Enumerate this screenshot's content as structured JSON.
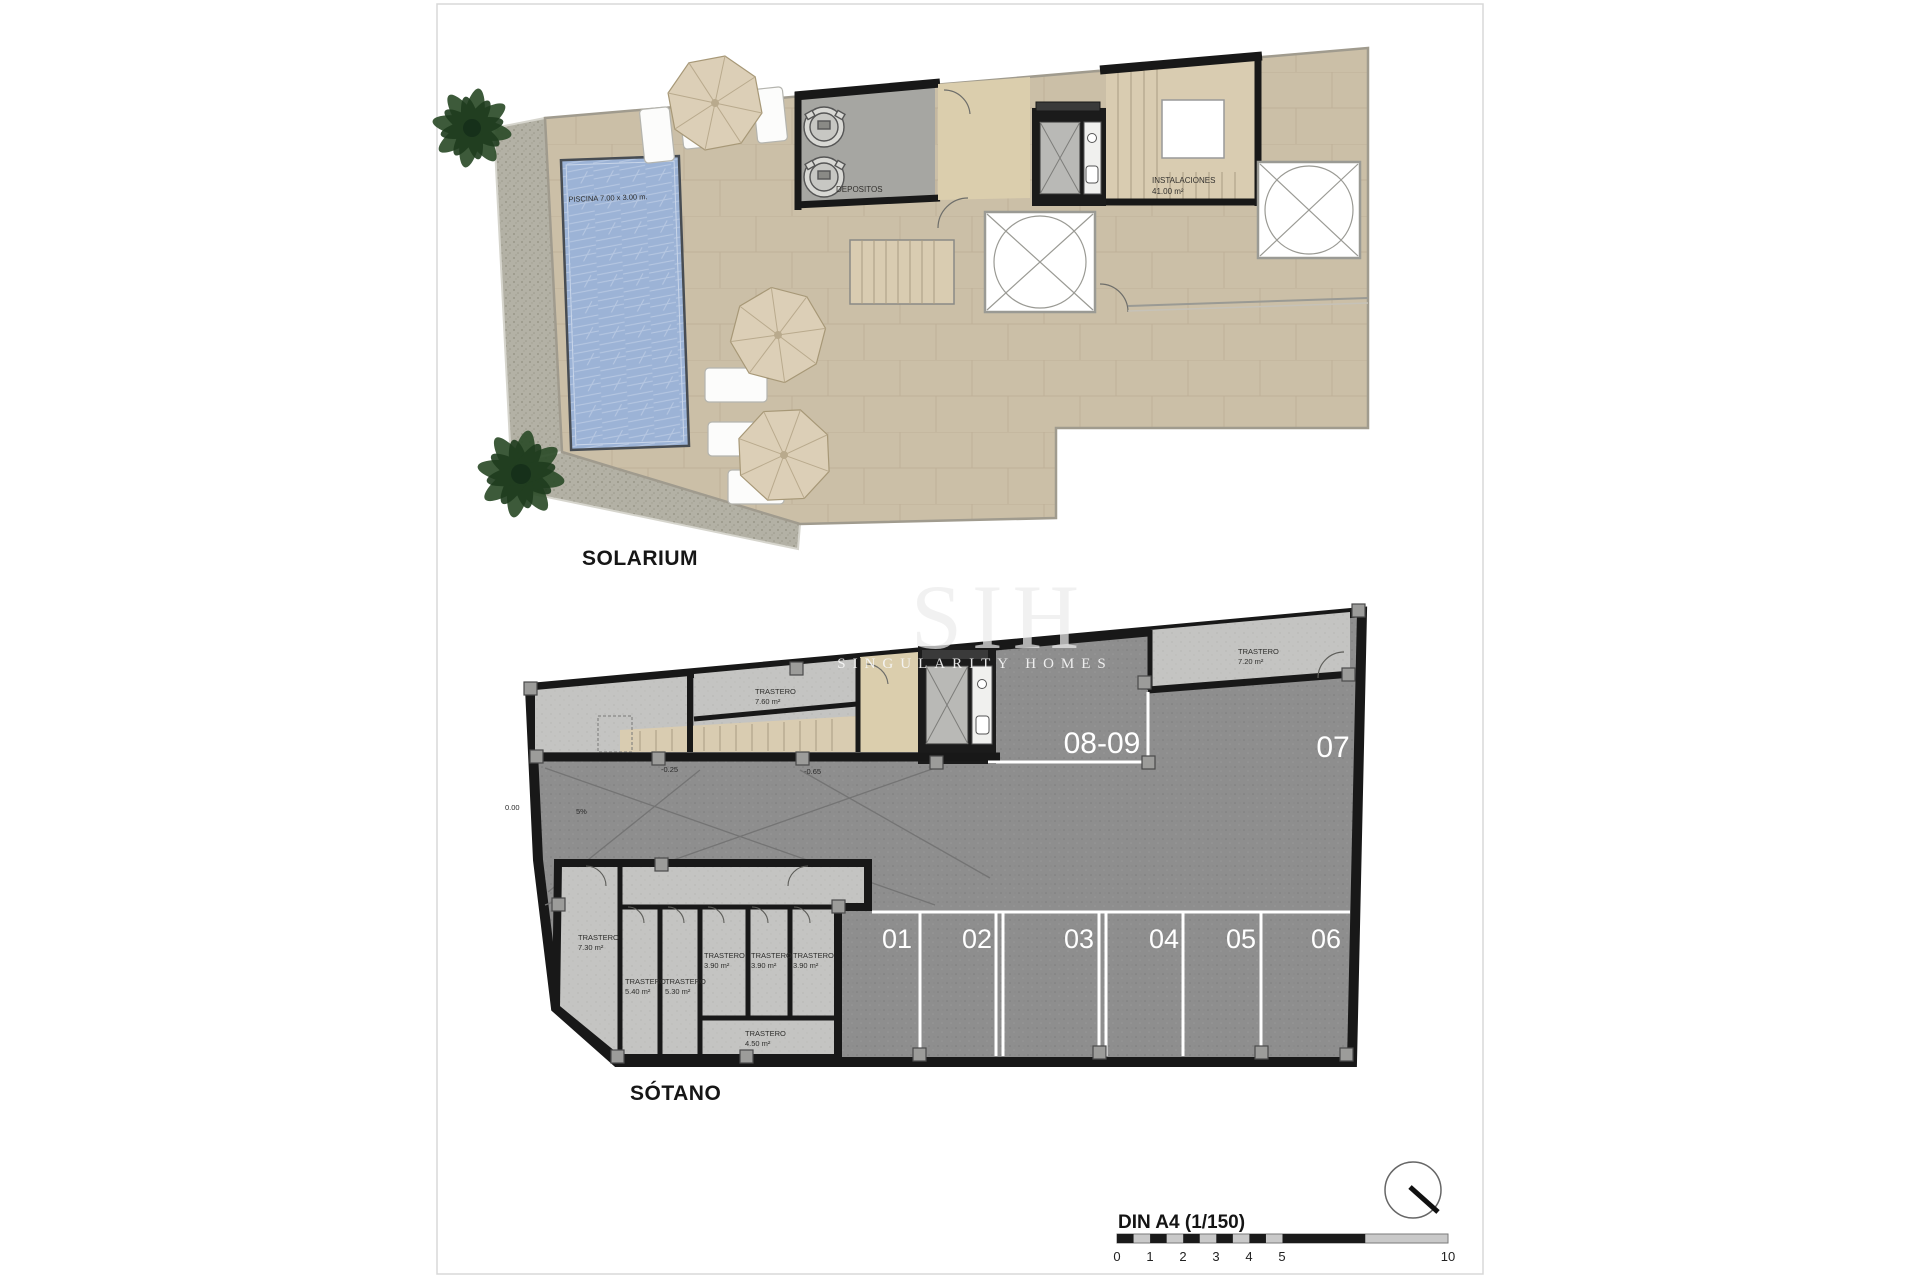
{
  "watermark": {
    "logo": "SIH",
    "name": "SINGULARITY HOMES"
  },
  "solarium": {
    "title": "SOLARIUM",
    "pool": {
      "dimensions": "PISCINA 7.00 x 3.00 m.",
      "name": "PISCINA",
      "area": "85.80 m²"
    },
    "rooms": {
      "depositos": {
        "name": "DEPOSITOS"
      },
      "instalaciones": {
        "name": "INSTALACIONES",
        "area": "41.00 m²"
      }
    }
  },
  "sotano": {
    "title": "SÓTANO",
    "storage_rooms": [
      {
        "name": "TRASTERO",
        "area": "7.60 m²"
      },
      {
        "name": "TRASTERO",
        "area": "7.20 m²"
      },
      {
        "name": "TRASTERO",
        "area": "7.30 m²"
      },
      {
        "name": "TRASTERO",
        "area": "5.40 m²"
      },
      {
        "name": "TRASTERO",
        "area": "5.30 m²"
      },
      {
        "name": "TRASTERO",
        "area": "3.90 m²"
      },
      {
        "name": "TRASTERO",
        "area": "3.90 m²"
      },
      {
        "name": "TRASTERO",
        "area": "3.90 m²"
      },
      {
        "name": "TRASTERO",
        "area": "4.50 m²"
      }
    ],
    "parking_bays": [
      "01",
      "02",
      "03",
      "04",
      "05",
      "06"
    ],
    "parking_double": "08-09",
    "parking_single": "07",
    "levels": {
      "zero": "0.00",
      "minus25": "-0.25",
      "minus65": "-0.65",
      "slope": "5%"
    }
  },
  "scale_bar": {
    "label": "DIN A4 (1/150)",
    "ticks": [
      "0",
      "1",
      "2",
      "3",
      "4",
      "5",
      "10"
    ]
  },
  "colors": {
    "deck_tan": "#cbbfa7",
    "gravel": "#b3b1a5",
    "pool_blue": "#9cb3d6",
    "wall_black": "#181818",
    "parking_gray": "#8e8e8e",
    "room_light": "#c4c4c2",
    "interior_beige": "#d9ccb1",
    "line_white": "#ffffff"
  }
}
